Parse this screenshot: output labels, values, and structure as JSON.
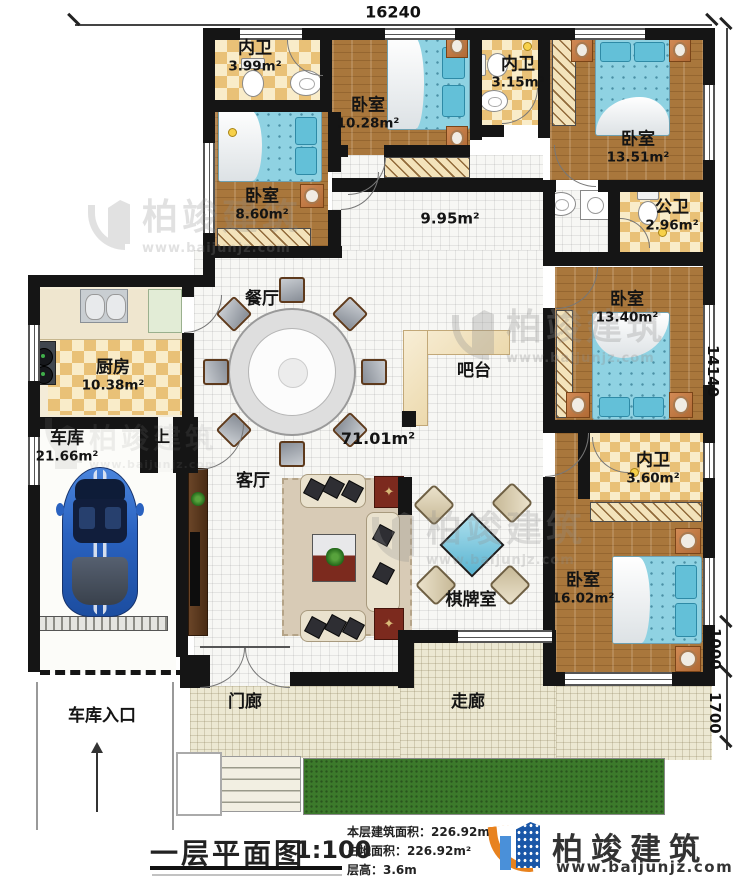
{
  "dimensions": {
    "top": "16240",
    "right_upper": "14140",
    "right_mid": "1000",
    "right_lower": "1700"
  },
  "rooms": {
    "bath1": {
      "name": "内卫",
      "area": "3.99m²"
    },
    "bed1": {
      "name": "卧室",
      "area": "10.28m²"
    },
    "bath2": {
      "name": "内卫",
      "area": "3.15m²"
    },
    "bed2": {
      "name": "卧室",
      "area": "13.51m²"
    },
    "bed3": {
      "name": "卧室",
      "area": "8.60m²"
    },
    "pubbath": {
      "name": "公卫",
      "area": "2.96m²"
    },
    "hallway": {
      "area": "9.95m²"
    },
    "dining": {
      "name": "餐厅"
    },
    "kitchen": {
      "name": "厨房",
      "area": "10.38m²"
    },
    "bed4": {
      "name": "卧室",
      "area": "13.40m²"
    },
    "bar": {
      "name": "吧台"
    },
    "open_space": {
      "area": "71.01m²"
    },
    "garage": {
      "name": "车库",
      "area": "21.66m²"
    },
    "stair": {
      "name": "上"
    },
    "living": {
      "name": "客厅"
    },
    "bath3": {
      "name": "内卫",
      "area": "3.60m²"
    },
    "bed5": {
      "name": "卧室",
      "area": "16.02m²"
    },
    "chess": {
      "name": "棋牌室"
    },
    "porch": {
      "name": "门廊"
    },
    "corridor": {
      "name": "走廊"
    },
    "garage_entry": {
      "name": "车库入口"
    }
  },
  "footer": {
    "plan_title": "一层平面图",
    "scale": "1:100",
    "stats": [
      {
        "label": "本层建筑面积：",
        "value": "226.92m²"
      },
      {
        "label": "占地面积：",
        "value": "226.92m²"
      },
      {
        "label": "层高：",
        "value": "3.6m"
      }
    ],
    "brand_name": "柏竣建筑",
    "brand_site": "www.baijunjz.com"
  },
  "watermark": {
    "name": "柏竣建筑",
    "site": "www.baijunjz.com"
  },
  "colors": {
    "wall": "#151515",
    "wood": "#a9773c",
    "checker_dark": "#e9c177",
    "checker_light": "#f9ecc9",
    "bed_blue": "#8fd2e2",
    "brand_blue": "#1a57a8",
    "brand_orange": "#e8821e",
    "grass": "#3c7a2b"
  }
}
